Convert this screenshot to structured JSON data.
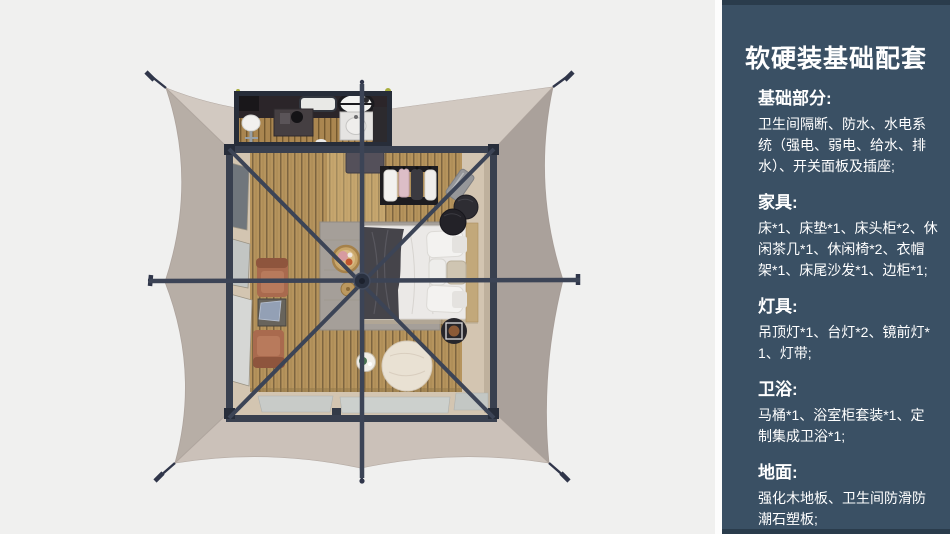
{
  "sidebar": {
    "title": "软硬装基础配套",
    "sections": [
      {
        "heading": "基础部分:",
        "body": "卫生间隔断、防水、水电系统（强电、弱电、给水、排水）、开关面板及插座;"
      },
      {
        "heading": "家具:",
        "body": "床*1、床垫*1、床头柜*2、休闲茶几*1、休闲椅*2、衣帽架*1、床尾沙发*1、边柜*1;"
      },
      {
        "heading": "灯具:",
        "body": "吊顶灯*1、台灯*2、镜前灯*1、灯带;"
      },
      {
        "heading": "卫浴:",
        "body": "马桶*1、浴室柜套装*1、定制集成卫浴*1;"
      },
      {
        "heading": "地面:",
        "body": "强化木地板、卫生间防滑防潮石塑板;"
      }
    ],
    "colors": {
      "background": "#3a5064",
      "edge": "#2a3c4c",
      "text": "#ffffff"
    }
  },
  "floorplan": {
    "type": "top-down 3d render",
    "subject": "square glamping tent with bathroom annex",
    "colors": {
      "background": "#f0f0ef",
      "canvas": "#c2b8b0",
      "frame": "#39404f",
      "wood_floor": "#b6945d",
      "beige_floor": "#d3c5b1",
      "rug": "#a59f99",
      "bed": "#ebe9e7",
      "chair": "#a96a4e",
      "pouf": "#e9e1d3"
    },
    "items": [
      "tent-canvas",
      "guy-line-stakes",
      "bathroom-annex",
      "toilet",
      "bathtub-oval",
      "washbasin-unit",
      "vanity-cabinet",
      "skylight",
      "bedroom",
      "bed",
      "pillows",
      "throw-blanket",
      "headboard",
      "rug",
      "clothes-rack",
      "hanging-clothes",
      "luggage-rack",
      "dark-poufs",
      "side-table-tray",
      "cream-ottoman",
      "tray-table",
      "pet-basket",
      "stool",
      "lounge-chairs",
      "tea-table",
      "window-flaps",
      "floor-mats",
      "frame-braces",
      "center-hub"
    ]
  }
}
